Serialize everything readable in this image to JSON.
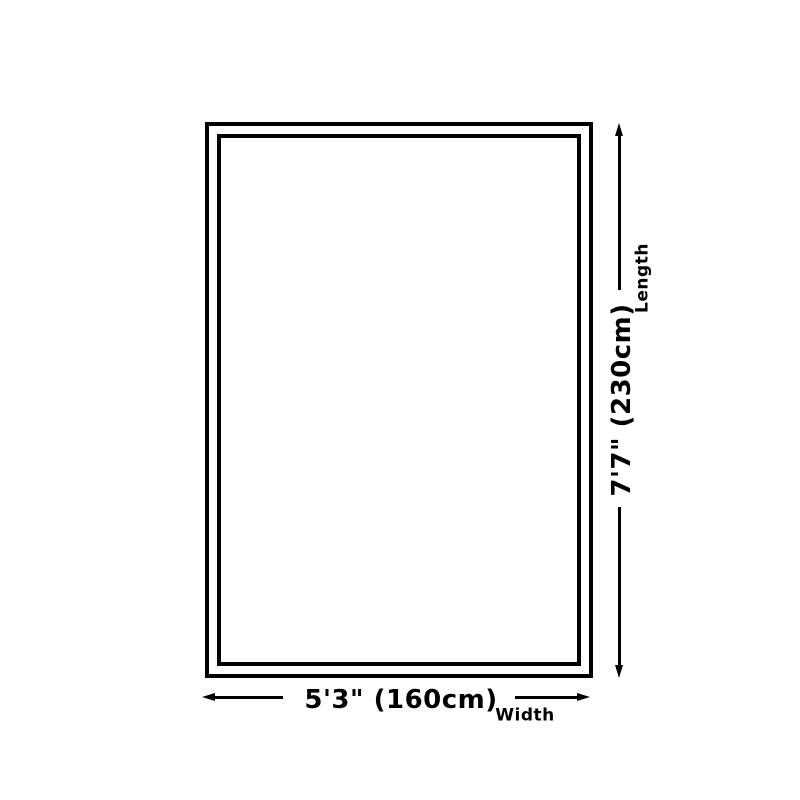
{
  "diagram": {
    "type": "product-size-diagram",
    "length": {
      "value": "7'7\" (230cm)",
      "axis": "Length"
    },
    "width": {
      "value": "5'3\" (160cm)",
      "axis": "Width"
    },
    "colors": {
      "line": "#000000",
      "background": "#ffffff"
    }
  }
}
